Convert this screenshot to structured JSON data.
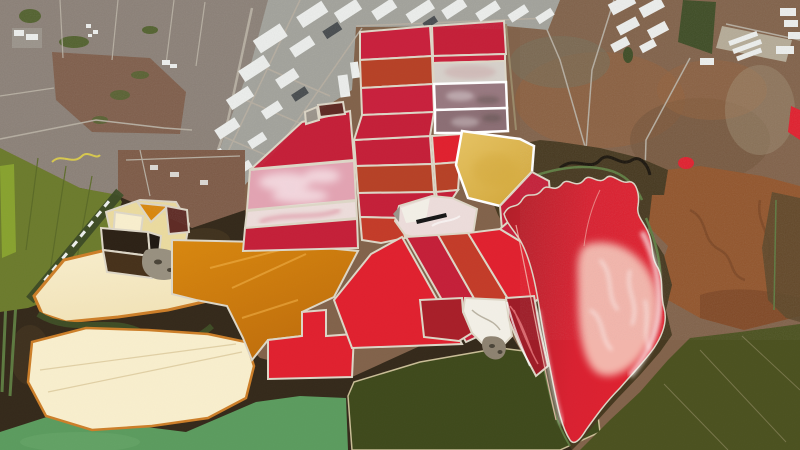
{
  "scene": {
    "name": "aerial-salt-evaporation-ponds",
    "type": "satellite-photograph",
    "description": "Aerial view of multicolored salt evaporation ponds beside an urban and industrial grid, tidal marsh and green bay waters"
  },
  "colors": {
    "base_upland": "#81624a",
    "upland_red": "#94613c",
    "upland_dark": "#6f5138",
    "upland_gray": "#76705a",
    "upland_light": "#a39378",
    "urban": "#8b8077",
    "urban_road": "#b5ada0",
    "urban_dirt": "#7d5a46",
    "park_green": "#52612e",
    "industrial": "#a2a29b",
    "bldg_white": "#eceeec",
    "bldg_dark": "#474b4e",
    "bldg_pad": "#b5ab97",
    "gray_pad": "#9a938a",
    "field_olive": "#6c7b2d",
    "field_bright": "#88a22f",
    "field_dark": "#5b6a27",
    "levee_band": "#3e4c25",
    "marsh_dark": "#34291a",
    "marsh_mid": "#4a3921",
    "marsh_band": "#46381f",
    "water_green": "#5b9b5e",
    "water_green_light": "#6aa86a",
    "pond_olive": "#3e491b",
    "water_olive": "#4b511f",
    "brown_pond": "#92552c",
    "brown_pond_dark": "#7a4523",
    "right_band": "#5a4629",
    "channel_green": "#5d7a40",
    "channel_black": "#1a140b",
    "cream": "#f2e3b8",
    "cream_pale": "#f8eecd",
    "cream_rim": "#cc7e28",
    "cream_line": "#d9c79a",
    "pale_yellow": "#eada9f",
    "orange": "#d8870e",
    "orange_deep": "#bf6d0b",
    "orange_streak": "#f2b34a",
    "yellow": "#e6c364",
    "yellow_deep": "#d3a83b",
    "crimson": "#c41f38",
    "crimson_bright": "#e0202e",
    "red_grid": "#c8203c",
    "red_dark": "#a81e28",
    "maroon_streak": "#9e1b26",
    "orange_red": "#b64126",
    "red_orange2": "#c33b28",
    "pink": "#e2a3b2",
    "pink_pale": "#ecdcda",
    "pink_swirl": "#d25070",
    "white_salt": "#f2efe6",
    "crystal": "#d6d0ca",
    "crystal_blotch": "#caa8a8",
    "mauve": "#97787f",
    "mauve_dark": "#8b6e74",
    "maroon": "#5e2a24",
    "dark_pond": "#2c2115",
    "dark_pond2": "#46311a",
    "dark_pond3": "#1f1812",
    "black_bar": "#161616",
    "island": "#8d8270",
    "island_speck": "#4a4438",
    "levee": "#ddd6c6",
    "lobe_red": "#d92030",
    "lobe_dark": "#b01e28",
    "lobe_pink": "#f5beb2",
    "white": "#ffffff",
    "gray_patch": "#98907f",
    "salt_streak_gray": "#b9b2a2",
    "pink_streak": "#e87a80",
    "yellow_line": "#d8c84a",
    "water_line": "#8a845c",
    "levee_tan": "#9a8a6a",
    "pond_edge_tan": "#c9bd96"
  }
}
